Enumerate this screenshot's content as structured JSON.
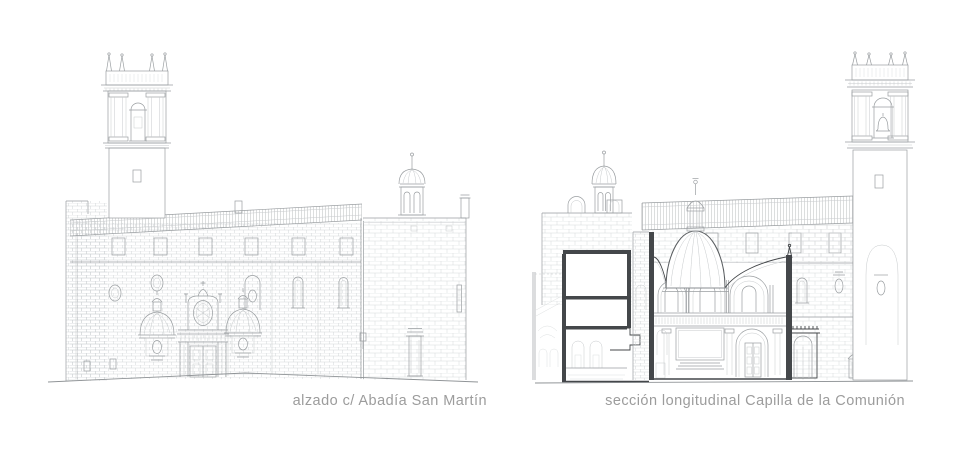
{
  "figure": {
    "type": "architectural-line-drawings",
    "panels": [
      {
        "id": "elevation-abadia-san-martin",
        "kind": "elevation",
        "caption": "alzado c/ Abadía San Martín"
      },
      {
        "id": "section-capilla-comunion",
        "kind": "longitudinal-section",
        "caption": "sección longitudinal Capilla de la Comunión"
      }
    ]
  },
  "colors": {
    "background": "#ffffff",
    "caption_text": "#9c9c9c",
    "line_medium": "#9a9ea1",
    "line_light": "#c7cacc",
    "line_extra_light": "#d8dbdc",
    "cut_line_dark": "#44474a"
  }
}
